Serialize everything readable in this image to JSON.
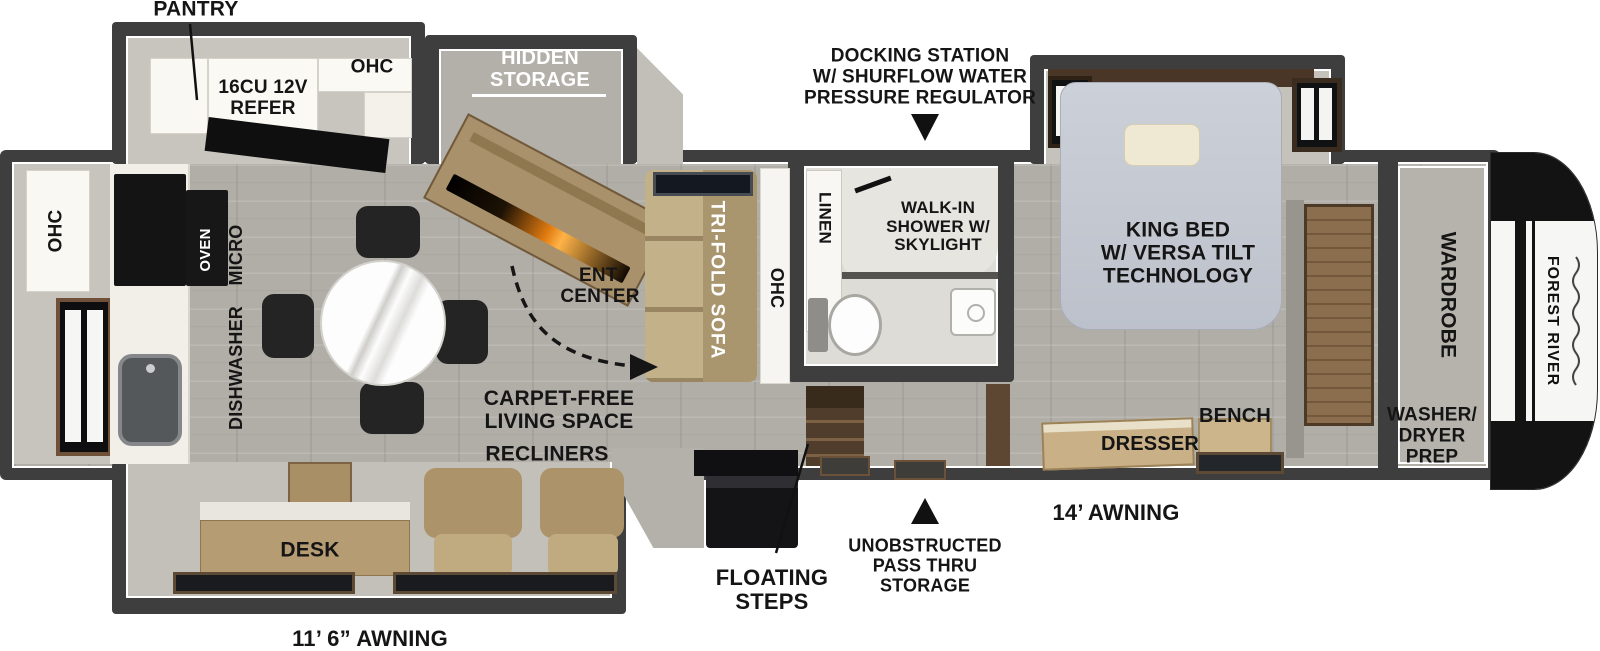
{
  "palette": {
    "wall": "#3e3e3e",
    "wood_tan": "#b29b73",
    "wood_dark": "#503d2b",
    "appliance_black": "#141414",
    "bed_gray": "#c9cdd6",
    "floor_tile": "#b1aea8",
    "label_black": "#151515",
    "label_white": "#ffffff"
  },
  "labels": {
    "pantry": "PANTRY",
    "refer": [
      "16CU 12V",
      "REFER"
    ],
    "ohc_top": "OHC",
    "hidden_storage": [
      "HIDDEN",
      "STORAGE"
    ],
    "docking": [
      "DOCKING STATION",
      "W/ SHURFLOW WATER",
      "PRESSURE REGULATOR"
    ],
    "ohc_left": "OHC",
    "oven": "OVEN",
    "micro": "MICRO",
    "dishwasher": "DISHWASHER",
    "ent_center": [
      "ENT.",
      "CENTER"
    ],
    "carpet_free": [
      "CARPET-FREE",
      "LIVING SPACE"
    ],
    "recliners": "RECLINERS",
    "tri_fold_sofa": "TRI-FOLD SOFA",
    "ohc_sofa": "OHC",
    "linen": "LINEN",
    "shower": [
      "WALK-IN",
      "SHOWER W/",
      "SKYLIGHT"
    ],
    "king_bed": [
      "KING BED",
      "W/ VERSA TILT",
      "TECHNOLOGY"
    ],
    "dresser": "DRESSER",
    "bench": "BENCH",
    "wardrobe": "WARDROBE",
    "washer_dryer": [
      "WASHER/",
      "DRYER",
      "PREP"
    ],
    "desk": "DESK",
    "floating_steps": [
      "FLOATING",
      "STEPS"
    ],
    "pass_thru": [
      "UNOBSTRUCTED",
      "PASS THRU",
      "STORAGE"
    ],
    "awning_right": "14’ AWNING",
    "awning_left": "11’ 6” AWNING",
    "brand": "FOREST RIVER"
  }
}
